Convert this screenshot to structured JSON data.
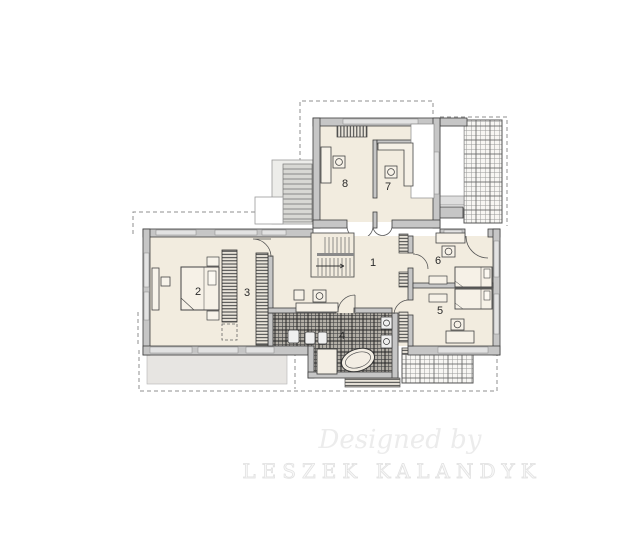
{
  "document": {
    "type": "architectural-floor-plan",
    "floor": "upper storey plan"
  },
  "rooms": [
    {
      "number": "1"
    },
    {
      "number": "2"
    },
    {
      "number": "3"
    },
    {
      "number": "4"
    },
    {
      "number": "5"
    },
    {
      "number": "6"
    },
    {
      "number": "7"
    },
    {
      "number": "8"
    }
  ],
  "watermark": {
    "line1": "Designed by",
    "line2": "LESZEK KALANDYK"
  },
  "colors": {
    "floor": "#f2ecdf",
    "tile_dark": "#b3afa7",
    "wall_fill": "#c6c6c6",
    "wall_edge": "#3c3c3c",
    "terrace_bg": "#f7f6f3",
    "balcony_gray": "#e7e5e2",
    "watermark": "#ececec"
  }
}
